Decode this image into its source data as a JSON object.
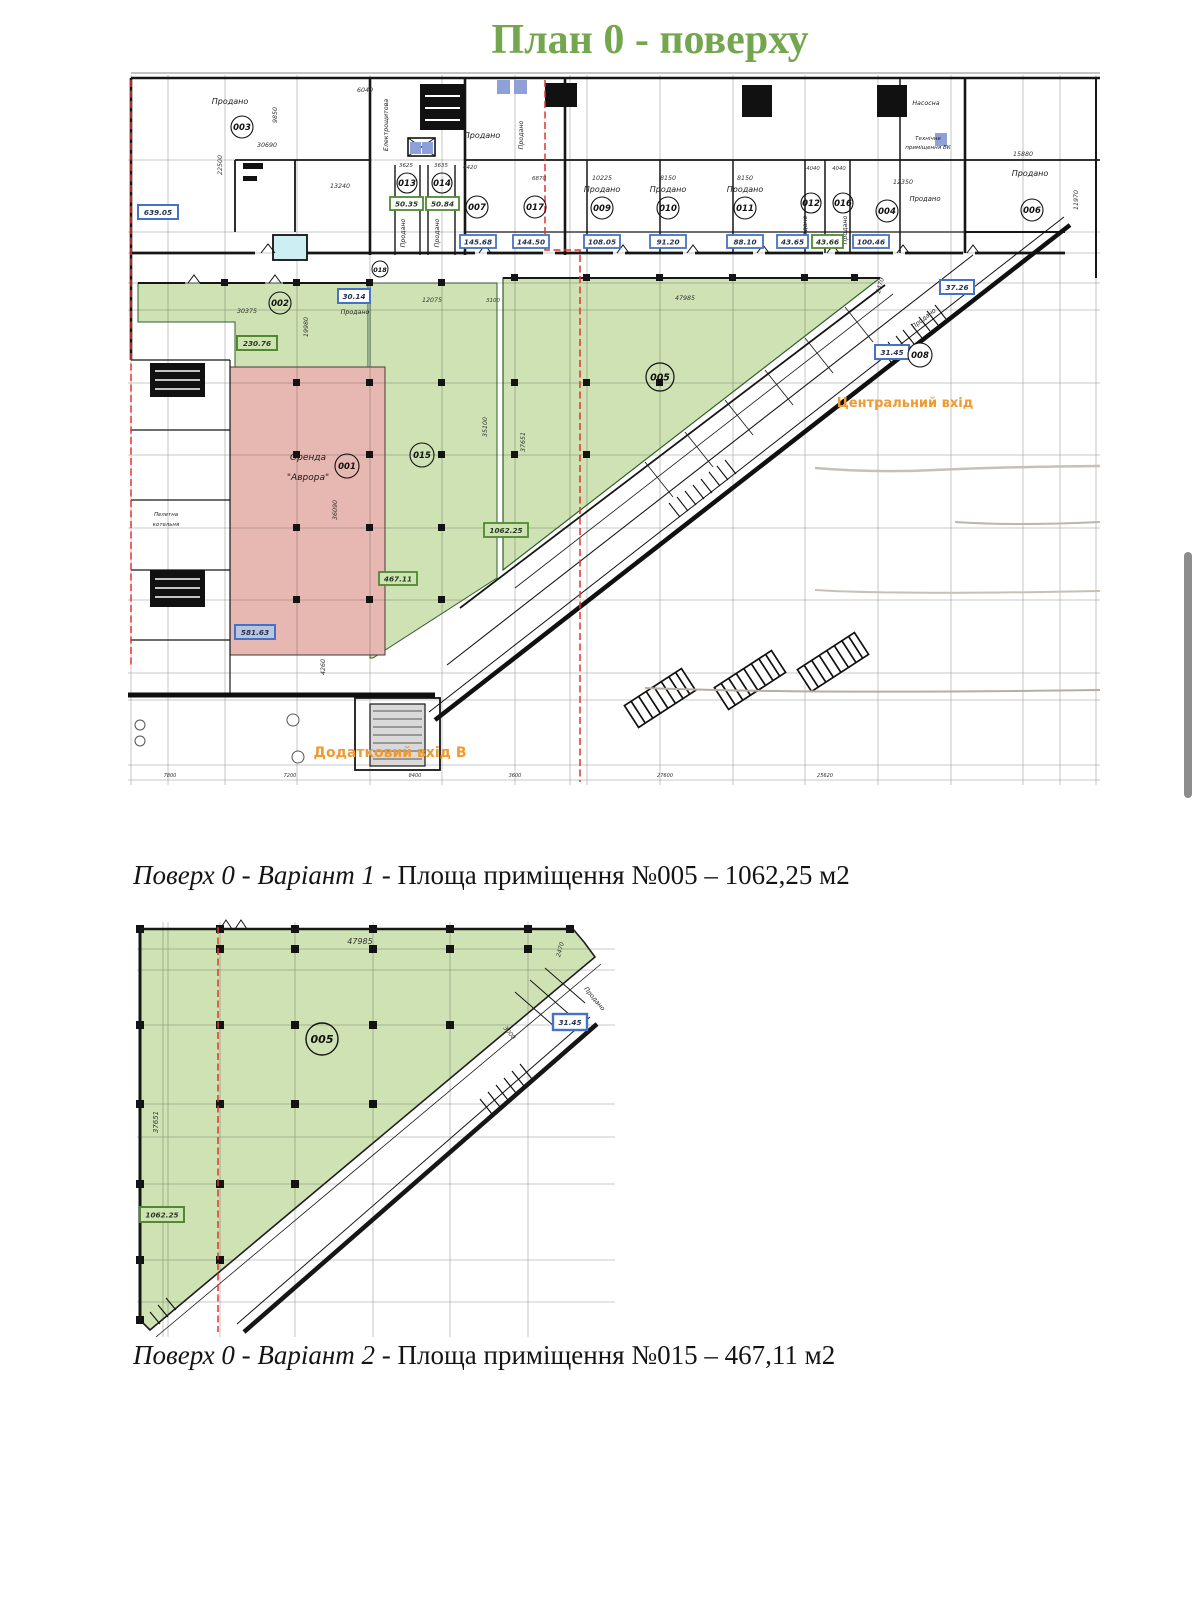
{
  "page": {
    "title": "План 0 - поверху",
    "caption1": {
      "italic": "Поверх 0 - Варіант 1",
      "rest": " - Площа приміщення №005 – 1062,25 м2"
    },
    "caption2": {
      "italic": "Поверх 0 - Варіант 2",
      "rest": " - Площа приміщення №015 – 467,11 м2"
    }
  },
  "colors": {
    "title_green": "#73a64e",
    "area_green_fill": "#cfe2b4",
    "rent_pink_fill": "#e7b7b1",
    "orange_label": "#f09a30",
    "blue_box_border": "#4472c4",
    "green_box_border": "#4f8a2f",
    "red_line": "#e2352b"
  },
  "p1": {
    "sold": "Продано",
    "rooms": {
      "r001": "001",
      "r002": "002",
      "r003": "003",
      "r004": "004",
      "r005": "005",
      "r006": "006",
      "r007": "007",
      "r008": "008",
      "r009": "009",
      "r010": "010",
      "r011": "011",
      "r012": "012",
      "r013": "013",
      "r014": "014",
      "r015": "015",
      "r016": "016",
      "r017": "017",
      "r018": "018"
    },
    "areas": {
      "a639": "639.05",
      "a013": "50.35",
      "a014": "50.84",
      "a007": "145.68",
      "a017": "144.50",
      "a009": "108.05",
      "a010": "91.20",
      "a011": "88.10",
      "a012": "43.65",
      "a016": "43.66",
      "a004": "100.46",
      "a3014": "30.14",
      "a230": "230.76",
      "a581": "581.63",
      "a467": "467.11",
      "a1062": "1062.25",
      "ad1": "31.45",
      "ad2": "37.26"
    },
    "dims": {
      "d30690": "30690",
      "d9850": "9850",
      "d22500": "22500",
      "d6040": "6040",
      "d13240": "13240",
      "d3625": "3625",
      "d3635": "3635",
      "d4420": "4420",
      "d6870": "6870",
      "d10225": "10225",
      "d8150": "8150",
      "d4040": "4040",
      "d12350": "12350",
      "d15880": "15880",
      "d11970": "11970",
      "d30375": "30375",
      "d19980": "19980",
      "d12075": "12075",
      "d3100": "3100",
      "d47985": "47985",
      "d2470": "2470",
      "d36090": "36090",
      "d4260": "4260",
      "d35100": "35100",
      "d37651": "37651"
    },
    "texts": {
      "elektro": "Електрощитова",
      "nasosna": "Насосна",
      "tech1": "Технічне",
      "tech2": "приміщення ВК",
      "pellet1": "Пелетна",
      "pellet2": "котельня",
      "orenda1": "Оренда",
      "orenda2": "\"Аврора\"",
      "central": "Центральний вхід",
      "entry_b": "Додатковий вхід В"
    },
    "dims_bottom": [
      "7800",
      "7200",
      "8400",
      "3600",
      "27600",
      "25620"
    ]
  },
  "p2": {
    "r005": "005",
    "d47985": "47985",
    "d37651": "37651",
    "d2470": "2470",
    "d3000": "3000",
    "a1062": "1062.25",
    "a_box": "31.45",
    "sold": "Продано"
  }
}
